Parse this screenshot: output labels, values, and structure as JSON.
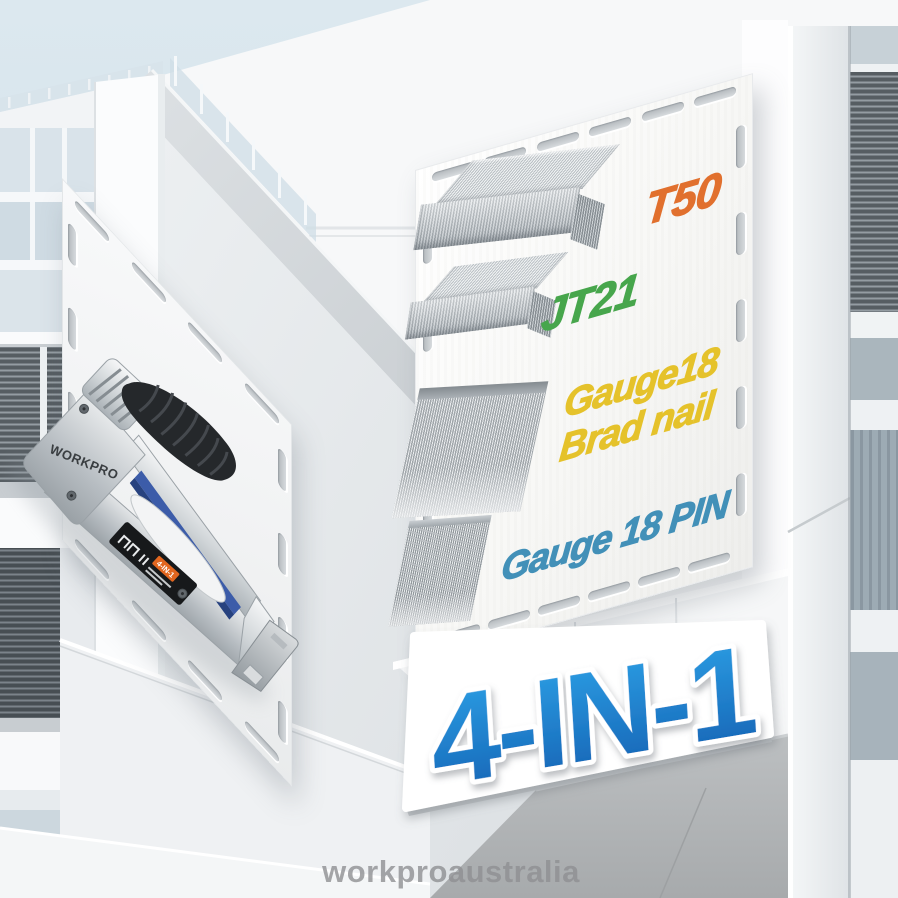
{
  "scene": {
    "watermark": "workproaustralia",
    "watermark_color": "#8f9093",
    "sky_color": "#d4e2eb"
  },
  "product_card": {
    "brand": "WORKPRO",
    "badge": "4-IN-1"
  },
  "staples_panel": {
    "items": [
      {
        "id": "t50",
        "lines": [
          "T50"
        ],
        "color": "#e1702e"
      },
      {
        "id": "jt21",
        "lines": [
          "JT21"
        ],
        "color": "#47a64c"
      },
      {
        "id": "brad",
        "lines": [
          "Gauge18",
          "Brad nail"
        ],
        "color": "#e5c22b"
      },
      {
        "id": "pin",
        "lines": [
          "Gauge 18 PIN"
        ],
        "color": "#4290b8"
      }
    ]
  },
  "banner": {
    "text": "4-IN-1",
    "fill_top": "#2ea3e8",
    "fill_bottom": "#1460b2"
  }
}
